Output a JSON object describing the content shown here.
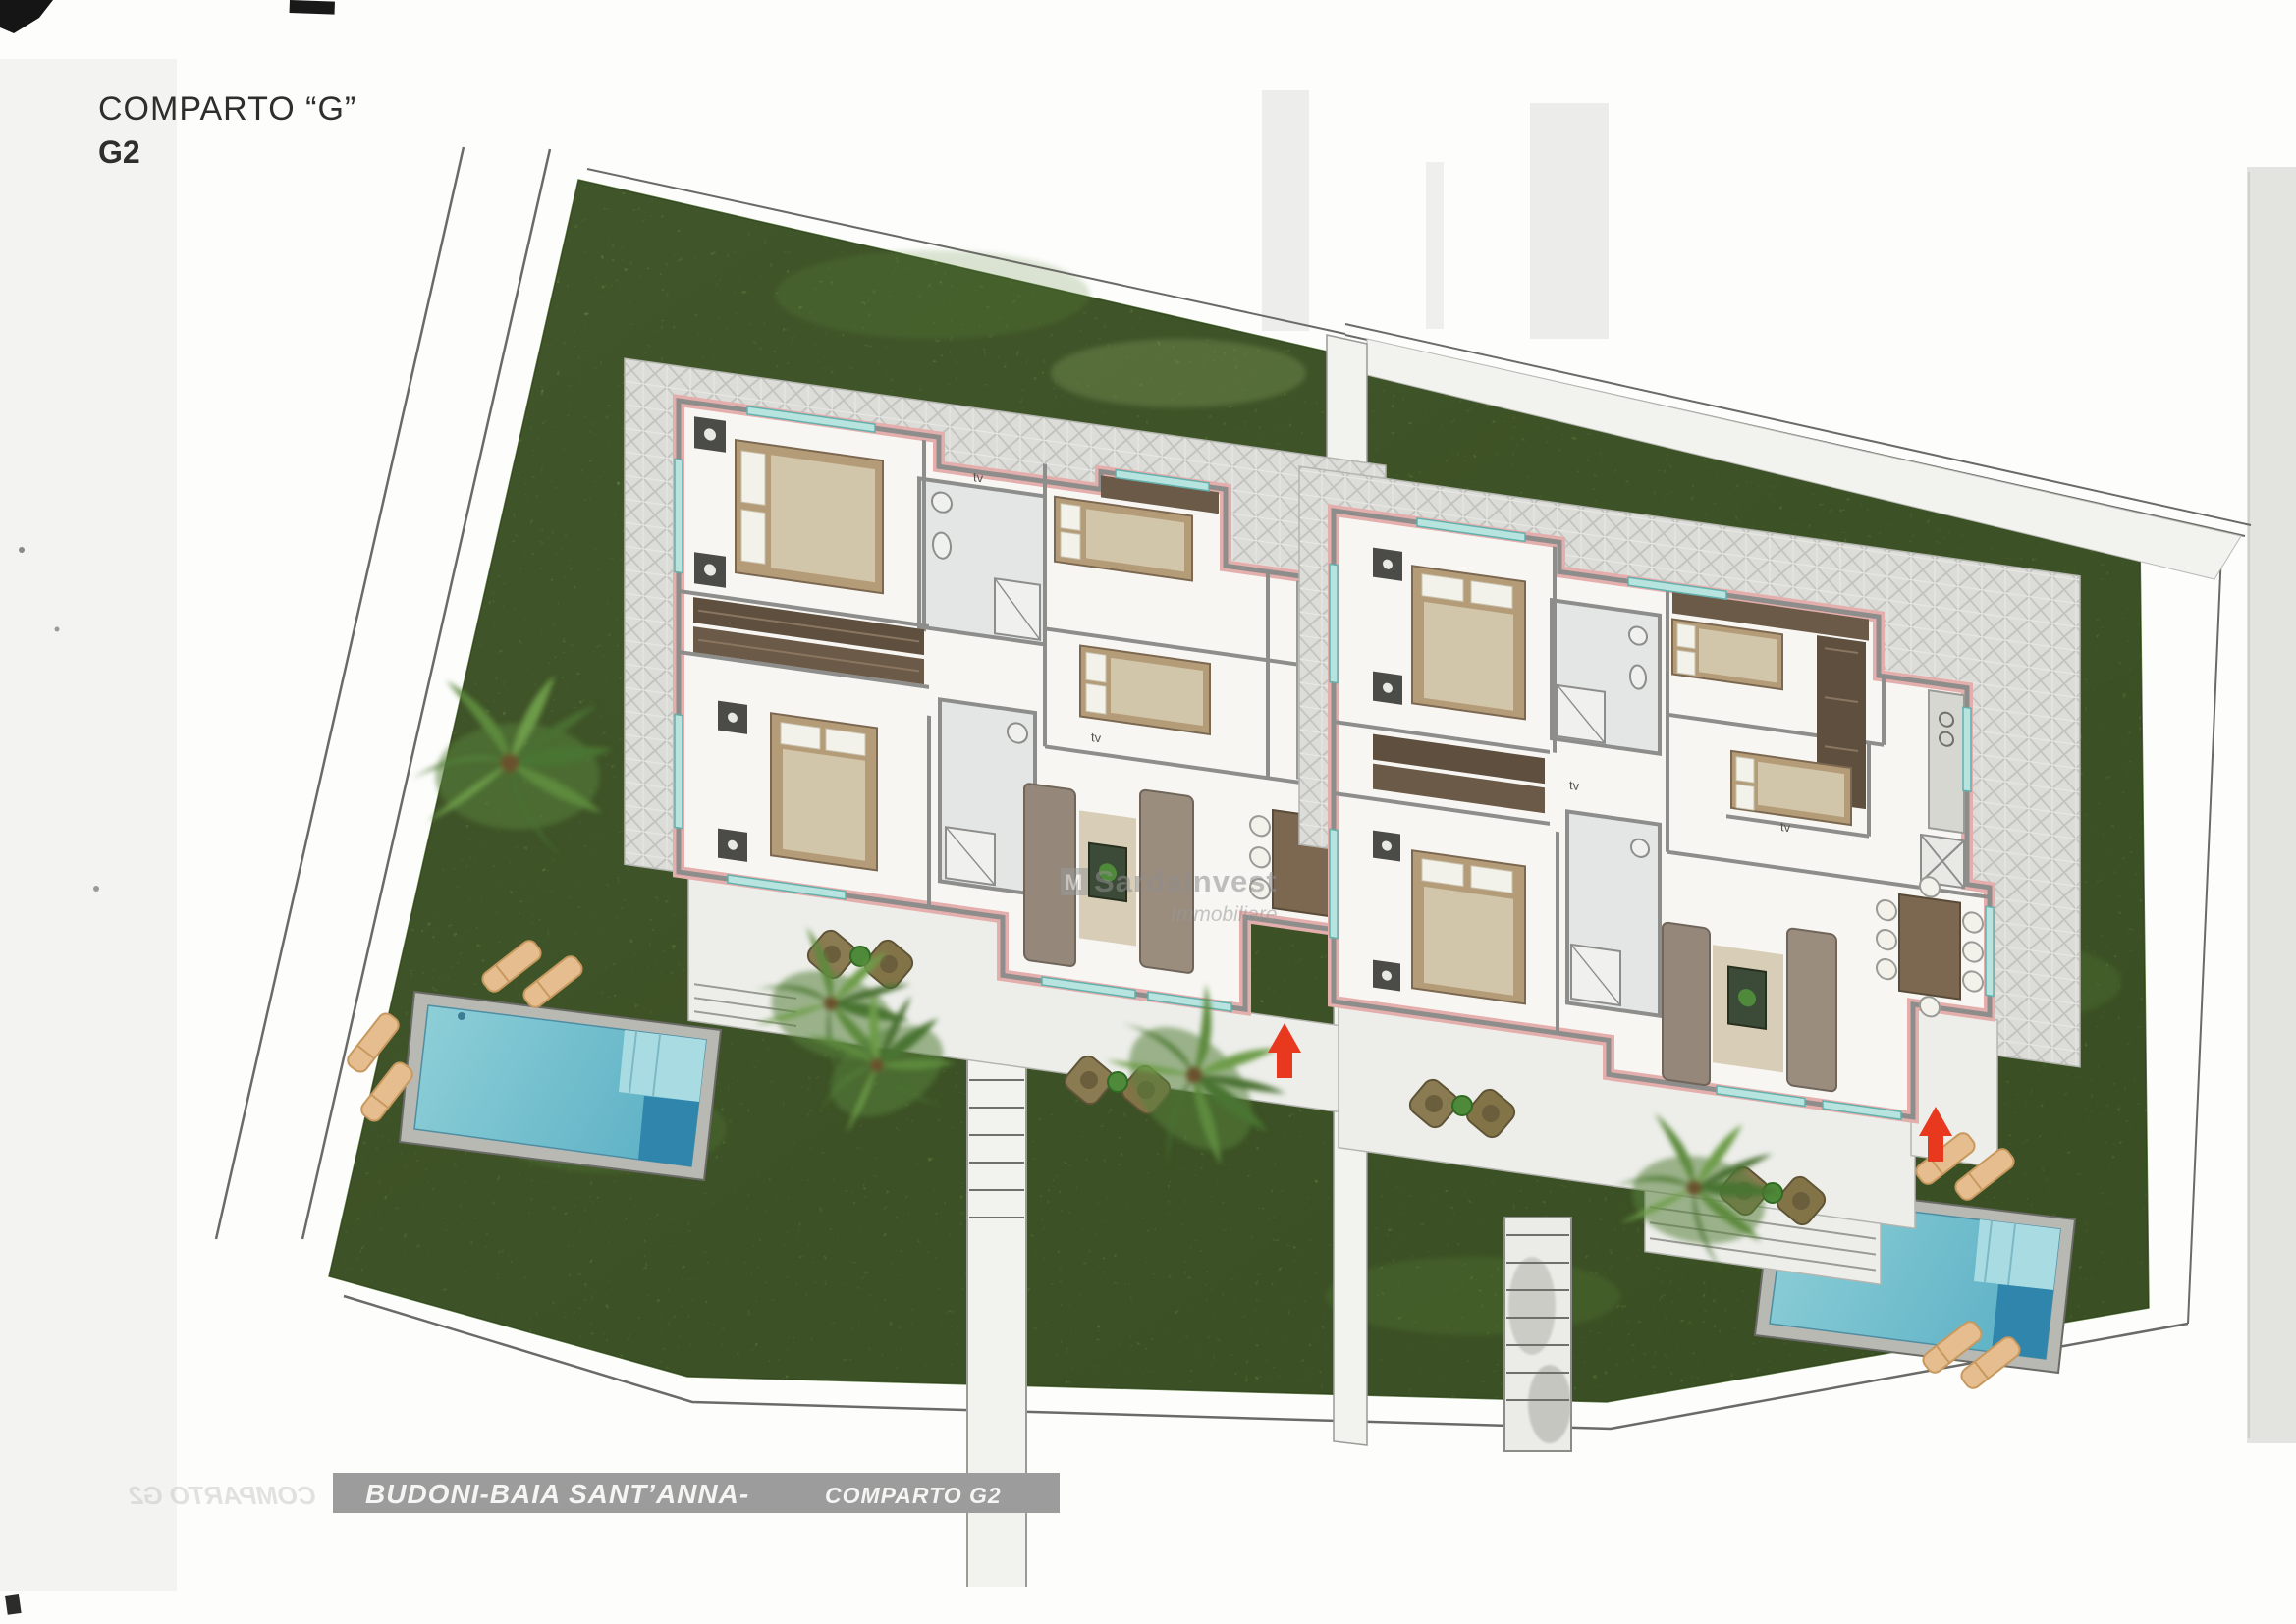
{
  "document": {
    "title_line1": "COMPARTO “G”",
    "title_line2": "G2"
  },
  "banner": {
    "location": "BUDONI-BAIA SANT’ANNA-",
    "section": "COMPARTO G2",
    "ghost": "COMPARTO G2"
  },
  "watermark": {
    "logo": "M",
    "brand": "SardaInvest",
    "sub": "Immobiliare"
  },
  "labels": {
    "tv": "tv"
  },
  "site": {
    "features": [
      "lawn",
      "boundary-lines",
      "villa-left",
      "villa-right",
      "terrace-paving",
      "pool-left",
      "pool-right",
      "palm-trees",
      "sun-loungers",
      "outdoor-tables",
      "walkways",
      "stairs",
      "entrance-arrow-left",
      "entrance-arrow-right"
    ]
  },
  "colors": {
    "grass": "#7ea951",
    "grass_dark": "#618c3c",
    "paving": "#dcdcd8",
    "wall_gray": "#8d8d8b",
    "outline_pink": "#e4aeac",
    "pool_water": "#7cc5d2",
    "pool_deep": "#2f85ab",
    "arrow_red": "#e8391f",
    "banner_bg": "#9c9c9c",
    "bed_wood": "#b59c79",
    "sofa": "#95887a"
  }
}
